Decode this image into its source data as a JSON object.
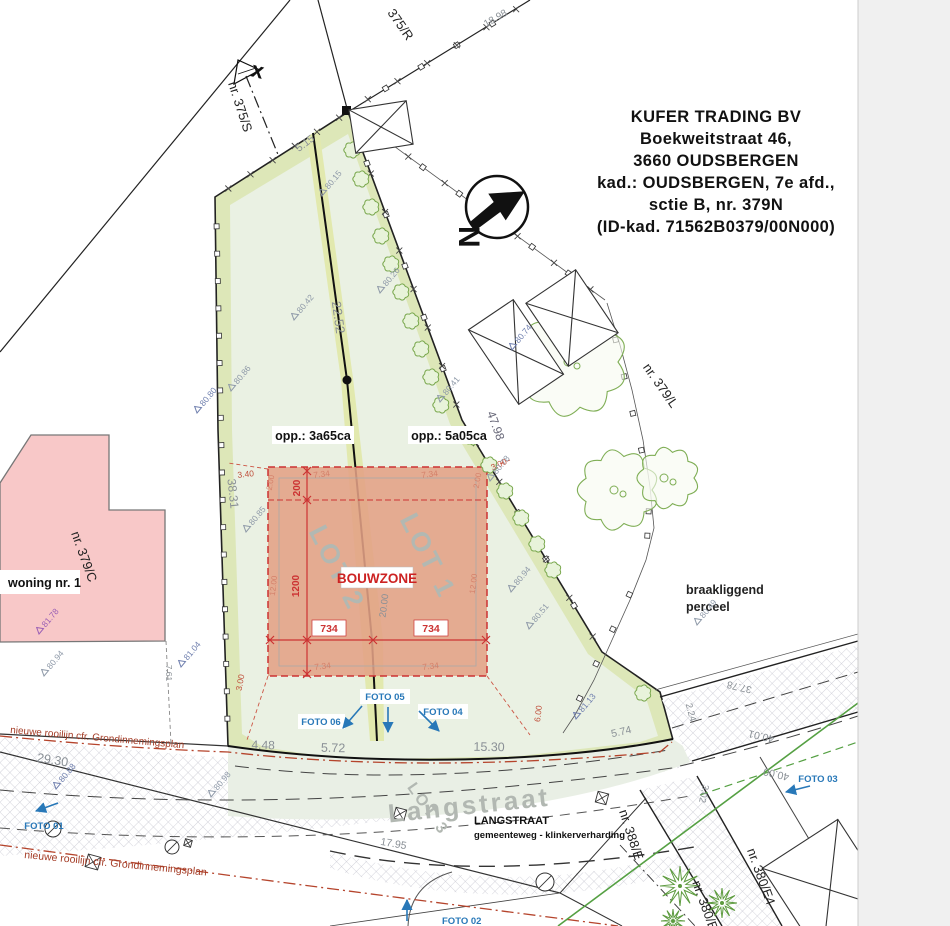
{
  "title_block": {
    "lines": [
      "KUFER TRADING BV",
      "Boekweitstraat 46,",
      "3660 OUDSBERGEN",
      "kad.: OUDSBERGEN, 7e afd.,",
      "sctie B, nr. 379N",
      "(ID-kad. 71562B0379/00N000)"
    ]
  },
  "north_arrow": {
    "letter": "N"
  },
  "boundary_marker": "x",
  "parcel_labels": {
    "p375R": "375/R",
    "p375S": "nr. 375/S",
    "p379L": "nr. 379/L",
    "p379C": "nr. 379/C",
    "p388E": "nr. 388/E",
    "p380E4": "nr. 380/E4",
    "p380E": "nr. 380/E"
  },
  "area_labels": {
    "opp_lot2": "opp.: 3a65ca",
    "opp_lot1": "opp.: 5a05ca",
    "bouwzone": "BOUWZONE",
    "lot1": "LOT 1",
    "lot2": "LOT 2",
    "lot3": "LOT 3",
    "woning": "woning nr. 1",
    "braakliggend_line1": "braakliggend",
    "braakliggend_line2": "perceel",
    "street_watermark": "Langstraat",
    "street_name": "LANGSTRAAT",
    "street_type": "gemeenteweg - klinkerverharding",
    "rooilijn_note": "nieuwe rooilijn cfr. Grondinnemingsplan"
  },
  "foto_labels": {
    "f1": "FOTO 01",
    "f2": "FOTO 02",
    "f3": "FOTO 03",
    "f4": "FOTO 04",
    "f5": "FOTO 05",
    "f6": "FOTO 06"
  },
  "dimensions": {
    "d5_15": "5.15",
    "d18_98": "18.98",
    "d22_52": "22.52",
    "d38_31": "38.31",
    "d47_98": "47.98",
    "d29_30": "29.30",
    "d4_48": "4.48",
    "d5_72": "5.72",
    "d15_30": "15.30",
    "d5_74": "5.74",
    "d2_24": "2.24",
    "d37_78": "37.78",
    "d40_01": "40.01",
    "d40_00": "40.00",
    "d3_02": "3.02",
    "d17_95": "17.95",
    "d7_61": "7.61"
  },
  "bouwzone_dims": {
    "depth_strip": "200",
    "depth_main": "1200",
    "width_left": "734",
    "width_right": "734",
    "edge_7_34": "7.34",
    "side_2_00": "2.00",
    "side_12_00": "12.00",
    "center_20_00": "20.00",
    "offset_3_40": "3.40",
    "offset_3_00": "3.00",
    "offset_6_00": "6.00"
  },
  "elevations": [
    {
      "v": "80.15",
      "x": 322,
      "y": 196,
      "c": "g"
    },
    {
      "v": "80.42",
      "x": 294,
      "y": 320,
      "c": "g"
    },
    {
      "v": "80.26",
      "x": 380,
      "y": 293,
      "c": "g"
    },
    {
      "v": "80.80",
      "x": 197,
      "y": 413,
      "c": "b"
    },
    {
      "v": "80.86",
      "x": 231,
      "y": 391,
      "c": "g"
    },
    {
      "v": "80.85",
      "x": 246,
      "y": 532,
      "c": "g"
    },
    {
      "v": "80.41",
      "x": 440,
      "y": 402,
      "c": "g"
    },
    {
      "v": "80.78",
      "x": 490,
      "y": 481,
      "c": "g"
    },
    {
      "v": "80.74",
      "x": 512,
      "y": 350,
      "c": "b"
    },
    {
      "v": "81.04",
      "x": 181,
      "y": 667,
      "c": "b"
    },
    {
      "v": "80.94",
      "x": 44,
      "y": 676,
      "c": "g"
    },
    {
      "v": "81.78",
      "x": 39,
      "y": 634,
      "c": "p"
    },
    {
      "v": "80.88",
      "x": 56,
      "y": 789,
      "c": "b"
    },
    {
      "v": "80.98",
      "x": 211,
      "y": 797,
      "c": "g"
    },
    {
      "v": "81.13",
      "x": 576,
      "y": 719,
      "c": "b"
    },
    {
      "v": "80.51",
      "x": 529,
      "y": 629,
      "c": "g"
    },
    {
      "v": "80.94",
      "x": 511,
      "y": 592,
      "c": "g"
    },
    {
      "v": "80.49",
      "x": 697,
      "y": 625,
      "c": "g"
    }
  ],
  "colors": {
    "parcel_fill": "#eaf1e3",
    "parcel_strip": "#dde7b8",
    "division_strip": "#e2e9ae",
    "bouwzone_fill": "#e2a085",
    "bouwzone_red": "#cc3333",
    "building_pink": "#f8c8c8",
    "foto_blue": "#2878b8",
    "rooilijn_red": "#a43c26",
    "tree_green": "#7fae55",
    "star_green": "#5d9b3f",
    "road_green": "#55a043",
    "dim_gray": "#8a9096",
    "elev_blue": "#6f7fae",
    "elev_gray": "#8e99a8",
    "elev_purple": "#9a5fb5"
  }
}
